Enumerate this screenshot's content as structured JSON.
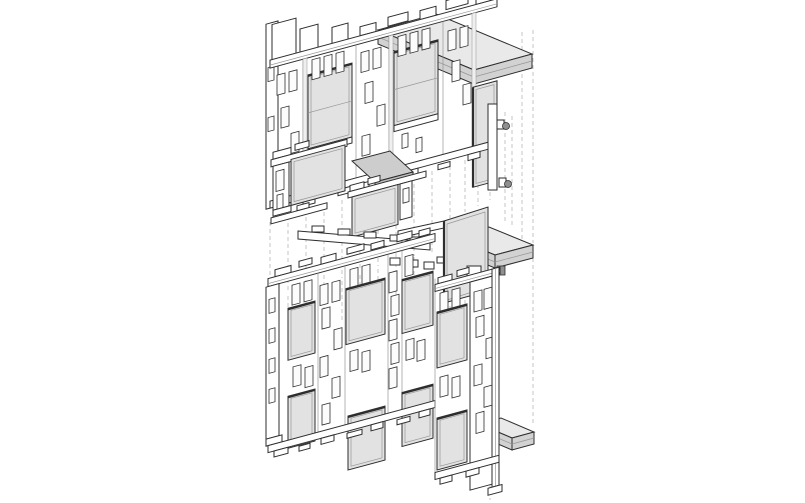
{
  "palette": {
    "background": "#ffffff",
    "line": "#2e2e2e",
    "line_light": "#969696",
    "glass": "#e2e2e2",
    "slab_top": "#e9e9e9",
    "slab_front": "#d2d2d2",
    "plate": "#cdcdcd",
    "plate_dark": "#bdbdbd",
    "panel_return": "#efefef",
    "dashed_guide": "#c4c4c4",
    "knob": "#8f8f8f"
  },
  "figure": {
    "kind": "axonometric facade assembly drawing",
    "tiers": [
      {
        "id": "upper-facade-slice"
      },
      {
        "id": "middle-facade-slice"
      },
      {
        "id": "lower-facade-slice"
      }
    ]
  }
}
